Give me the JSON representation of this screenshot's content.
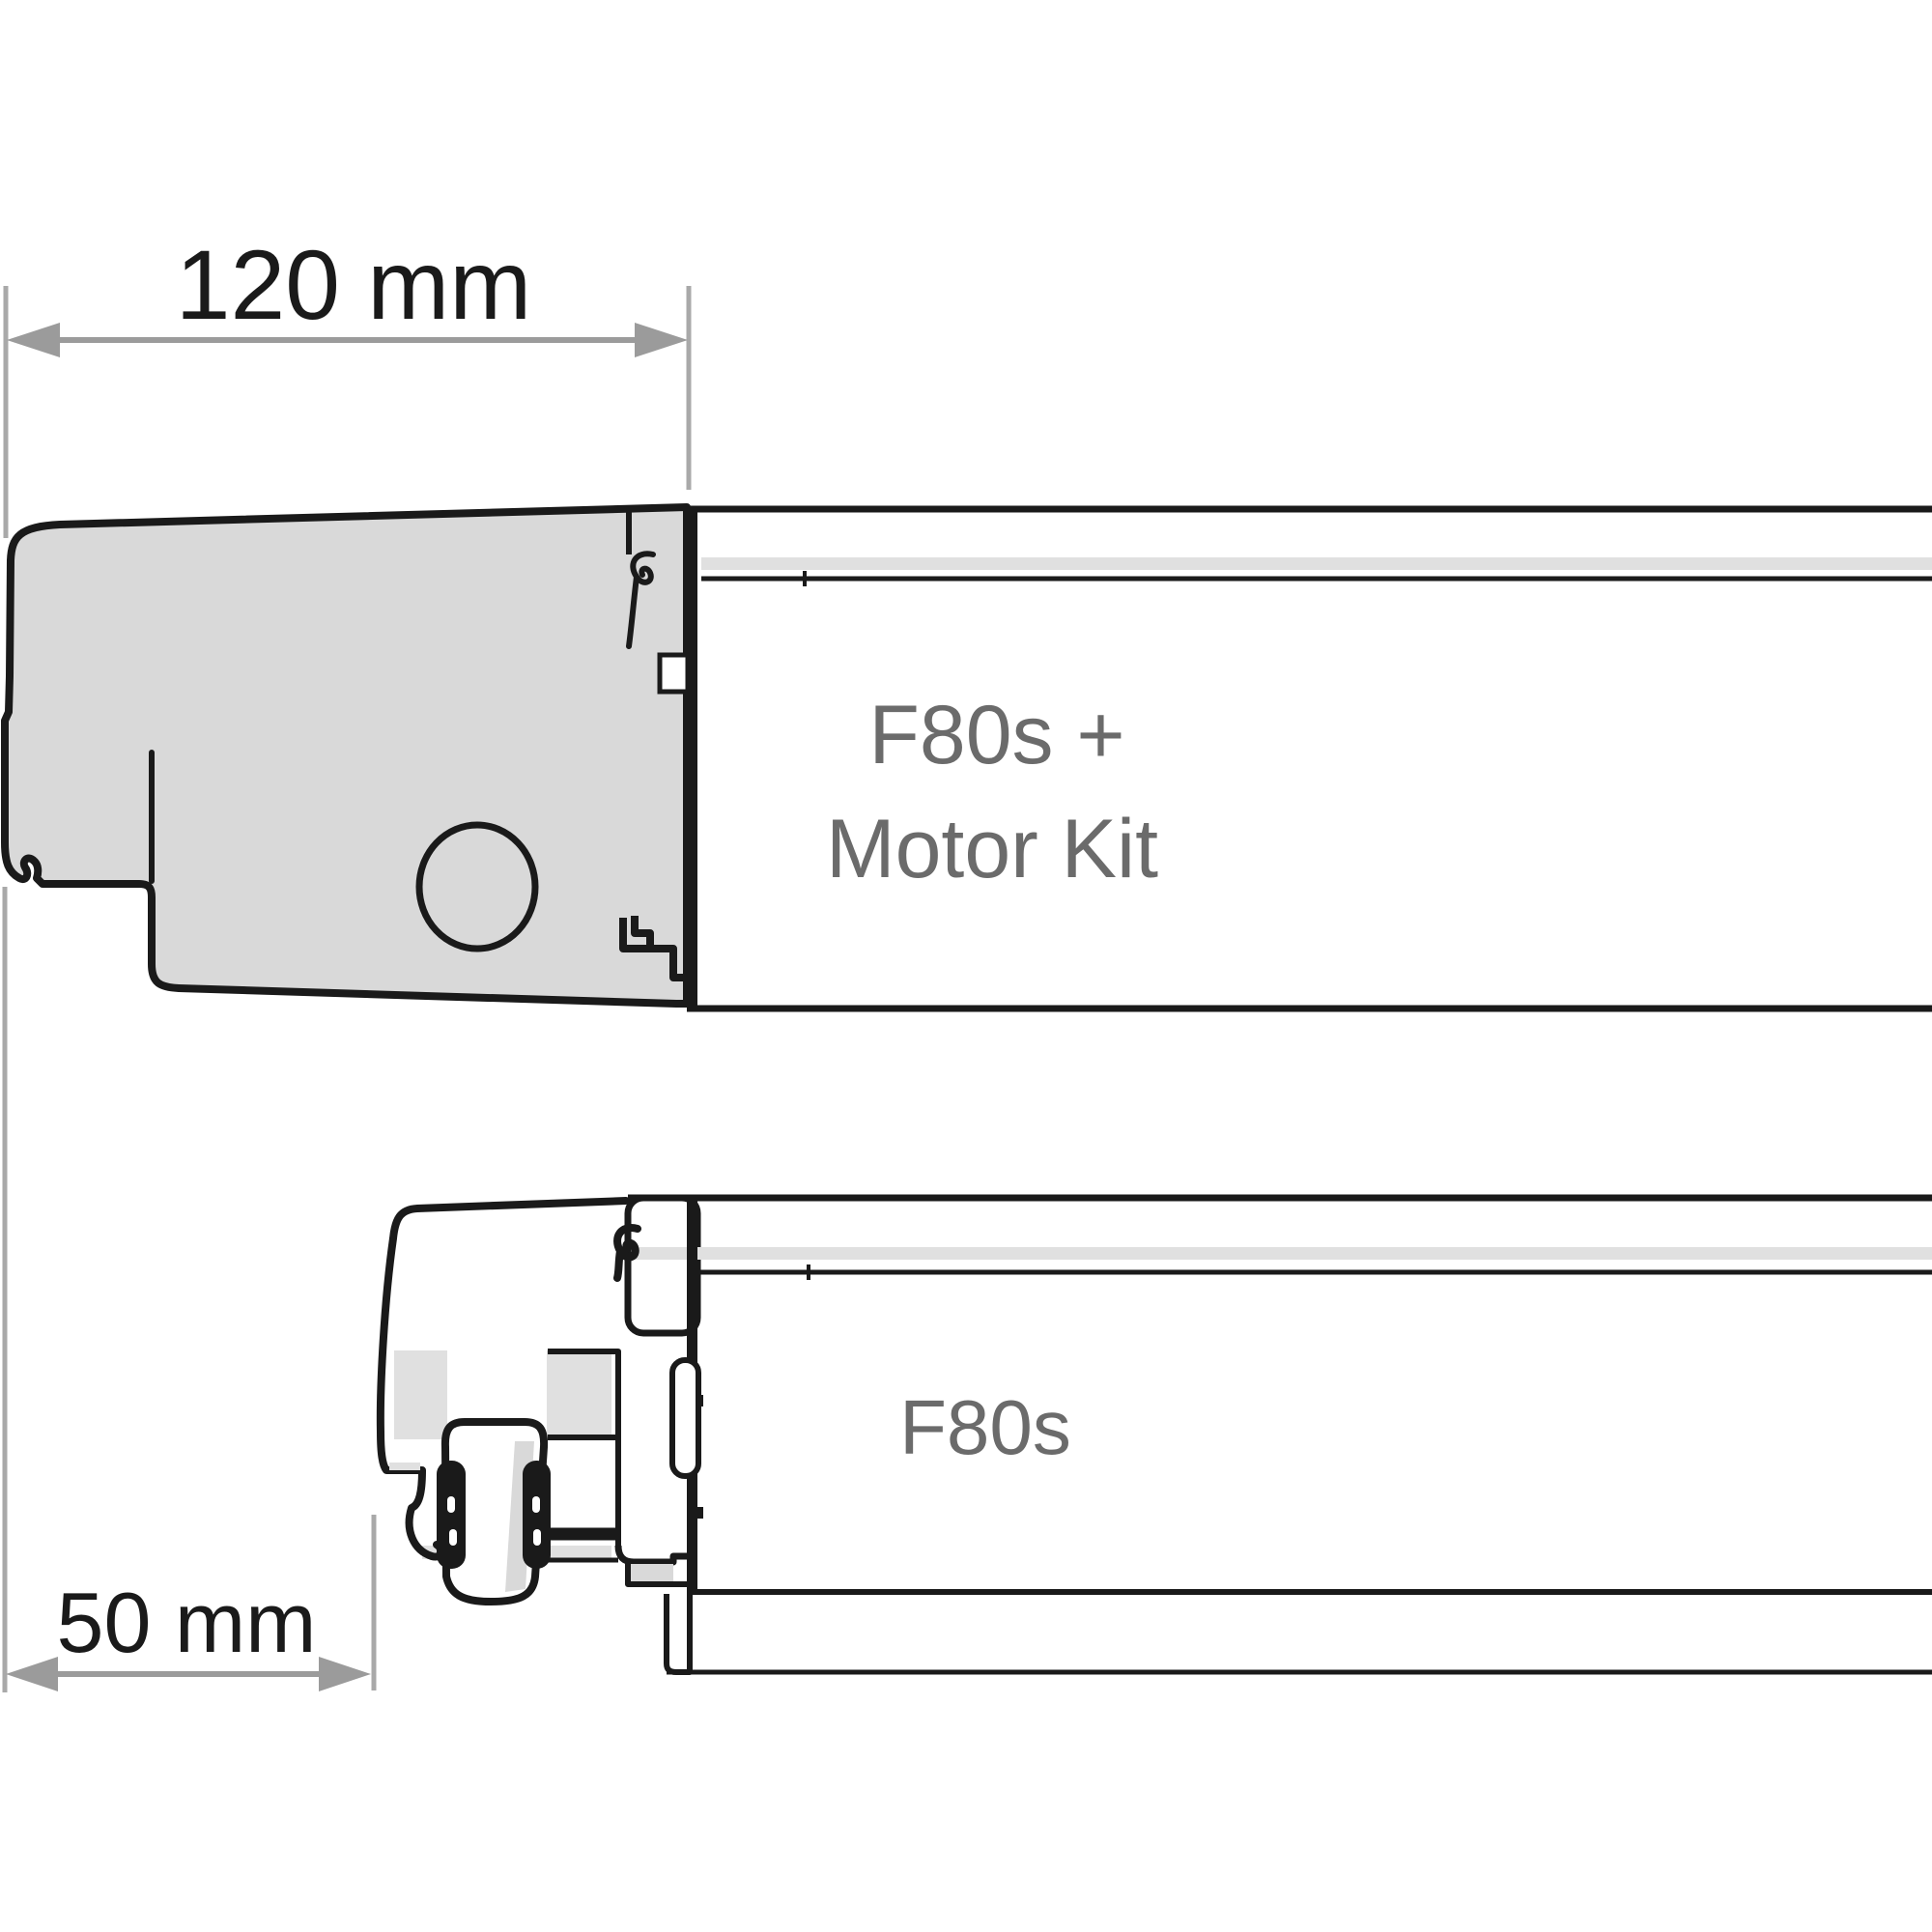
{
  "diagram": {
    "type": "technical-dimension-drawing",
    "product": "awning side profile comparison",
    "dimensions": {
      "motor_kit": {
        "label": "120 mm",
        "value_mm": 120,
        "unit": "mm"
      },
      "standard": {
        "label": "50 mm",
        "value_mm": 50,
        "unit": "mm"
      }
    },
    "labels": {
      "motor_kit_line1": "F80s +",
      "motor_kit_line2": "Motor Kit",
      "standard": "F80s"
    },
    "colors": {
      "outline": "#1a1a1a",
      "housing_fill": "#d9d9d9",
      "band_fill": "#e0e0e0",
      "dimension_arrow": "#9b9b9b",
      "extension_line": "#a9a9a9",
      "label_text": "#6b6b6b",
      "dimension_text": "#1a1a1a",
      "white": "#ffffff"
    }
  }
}
